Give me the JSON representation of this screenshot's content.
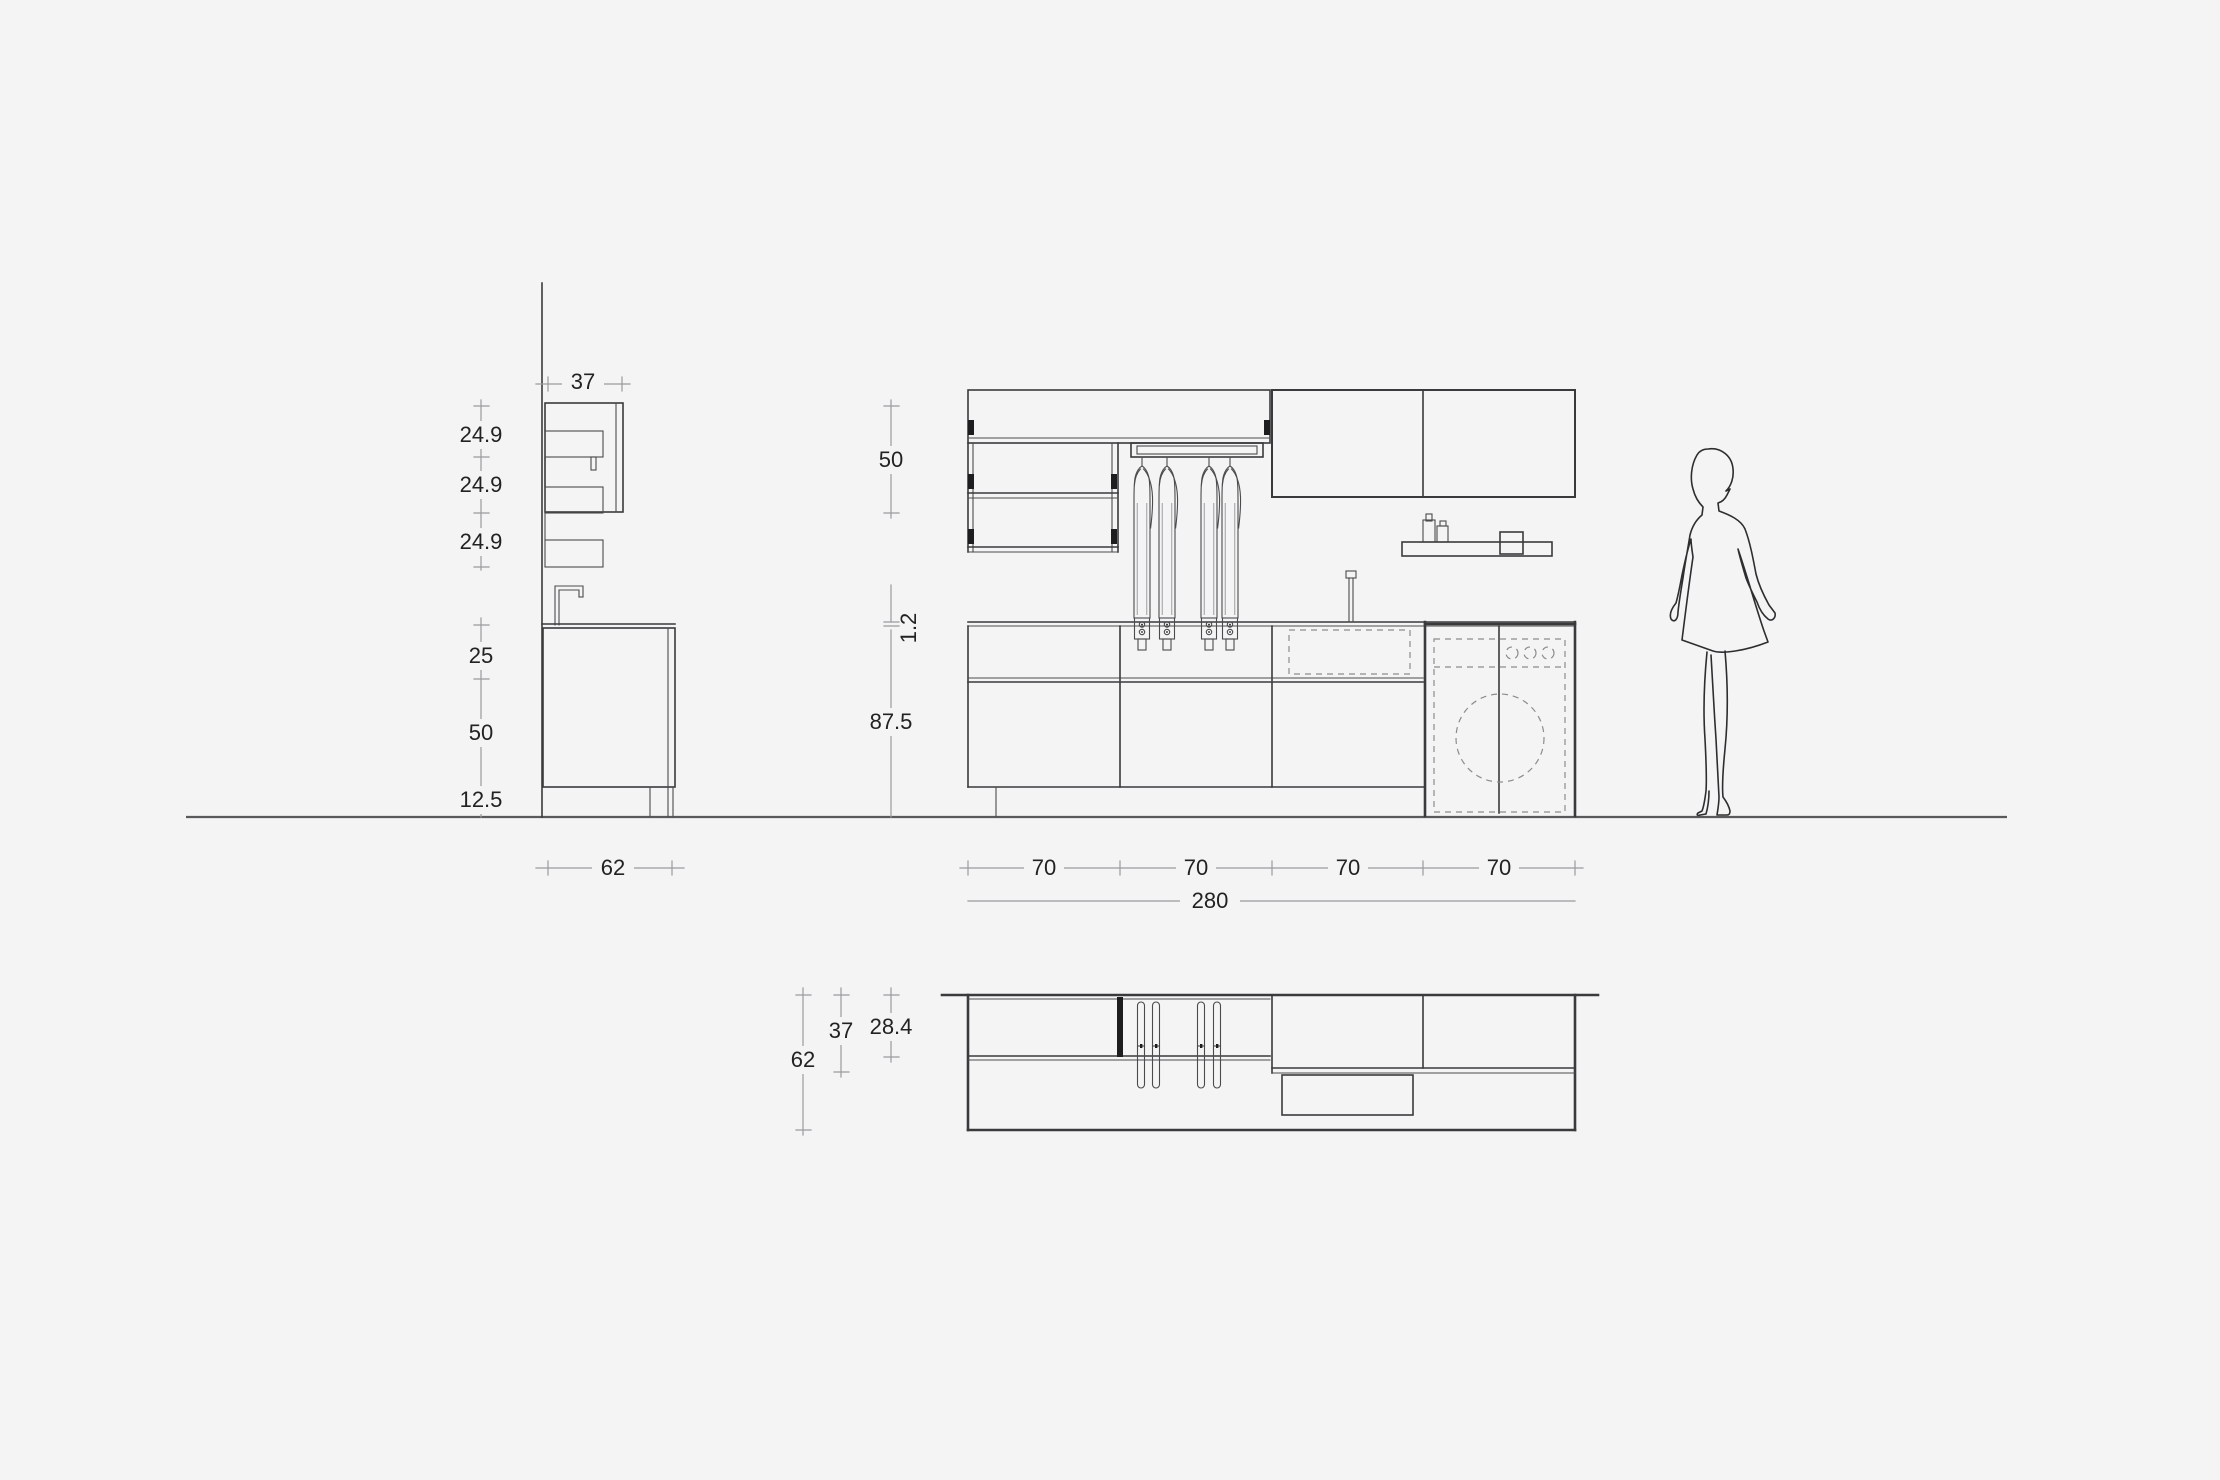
{
  "colors": {
    "background": "#f4f4f5",
    "line": "#3a3a3c",
    "dimension_line": "#9b9b9d",
    "text": "#222222"
  },
  "views": {
    "side_elevation": {
      "dims": {
        "top_width": "37",
        "shelf_gap_1": "24.9",
        "shelf_gap_2": "24.9",
        "shelf_gap_3": "24.9",
        "splash_height": "25",
        "base_height": "50",
        "plinth_height": "12.5",
        "depth": "62"
      }
    },
    "front_elevation": {
      "dims": {
        "wall_cabinet_height": "50",
        "counter_thickness": "1.2",
        "counter_height": "87.5",
        "module_1": "70",
        "module_2": "70",
        "module_3": "70",
        "module_4": "70",
        "total_width": "280"
      }
    },
    "plan_view": {
      "dims": {
        "total_depth": "62",
        "wall_cabinet_depth": "37",
        "shelf_depth": "28.4"
      }
    }
  }
}
